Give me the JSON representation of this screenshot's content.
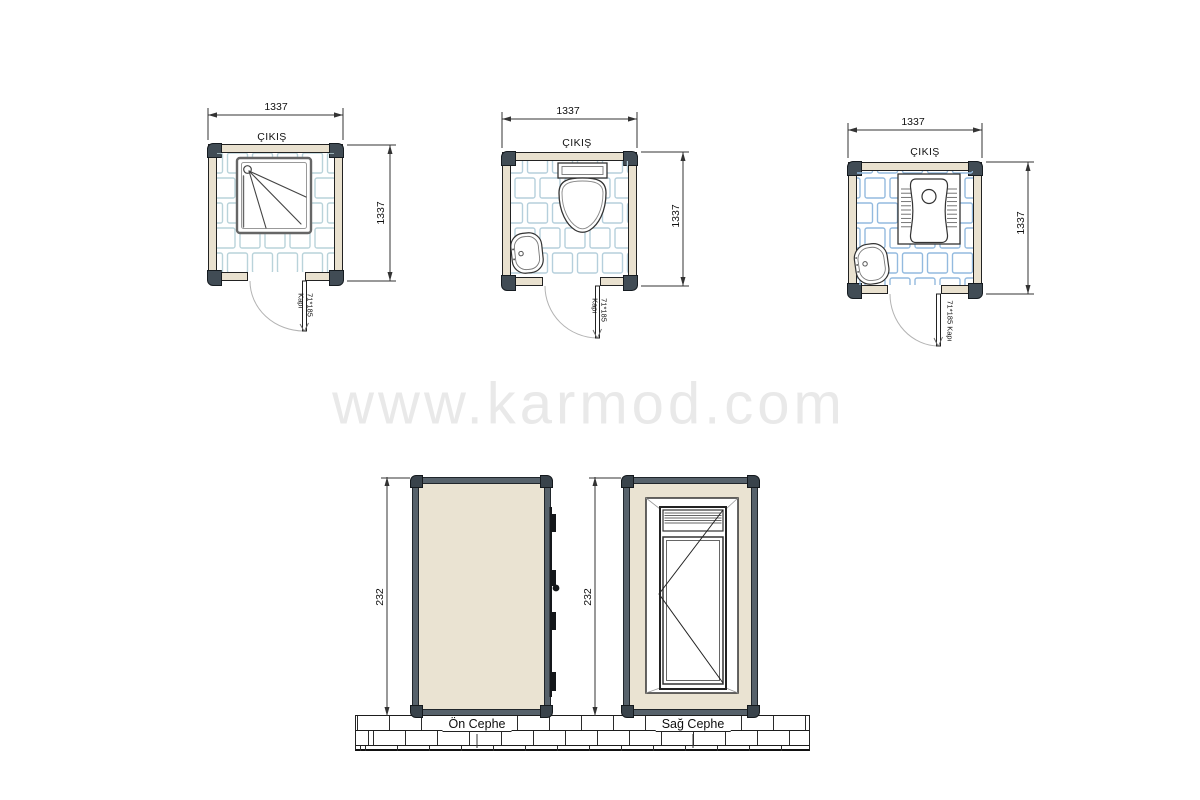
{
  "watermark": {
    "text": "www.karmod.com"
  },
  "plans": [
    {
      "id": "shower-cabin",
      "width_label": "1337",
      "height_label": "1337",
      "exit_label": "ÇIKIŞ",
      "door_size": "71*185",
      "door_word": "Kapı"
    },
    {
      "id": "toilet-cabin",
      "width_label": "1337",
      "height_label": "1337",
      "exit_label": "ÇIKIŞ",
      "door_size": "71*185",
      "door_word": "Kapı"
    },
    {
      "id": "squat-toilet-cabin",
      "width_label": "1337",
      "height_label": "1337",
      "exit_label": "ÇIKIŞ",
      "door_label": "71*185 Kapı"
    }
  ],
  "elevations": [
    {
      "caption": "Ön Cephe",
      "height_label": "232"
    },
    {
      "caption": "Sağ Cephe",
      "height_label": "232"
    }
  ]
}
